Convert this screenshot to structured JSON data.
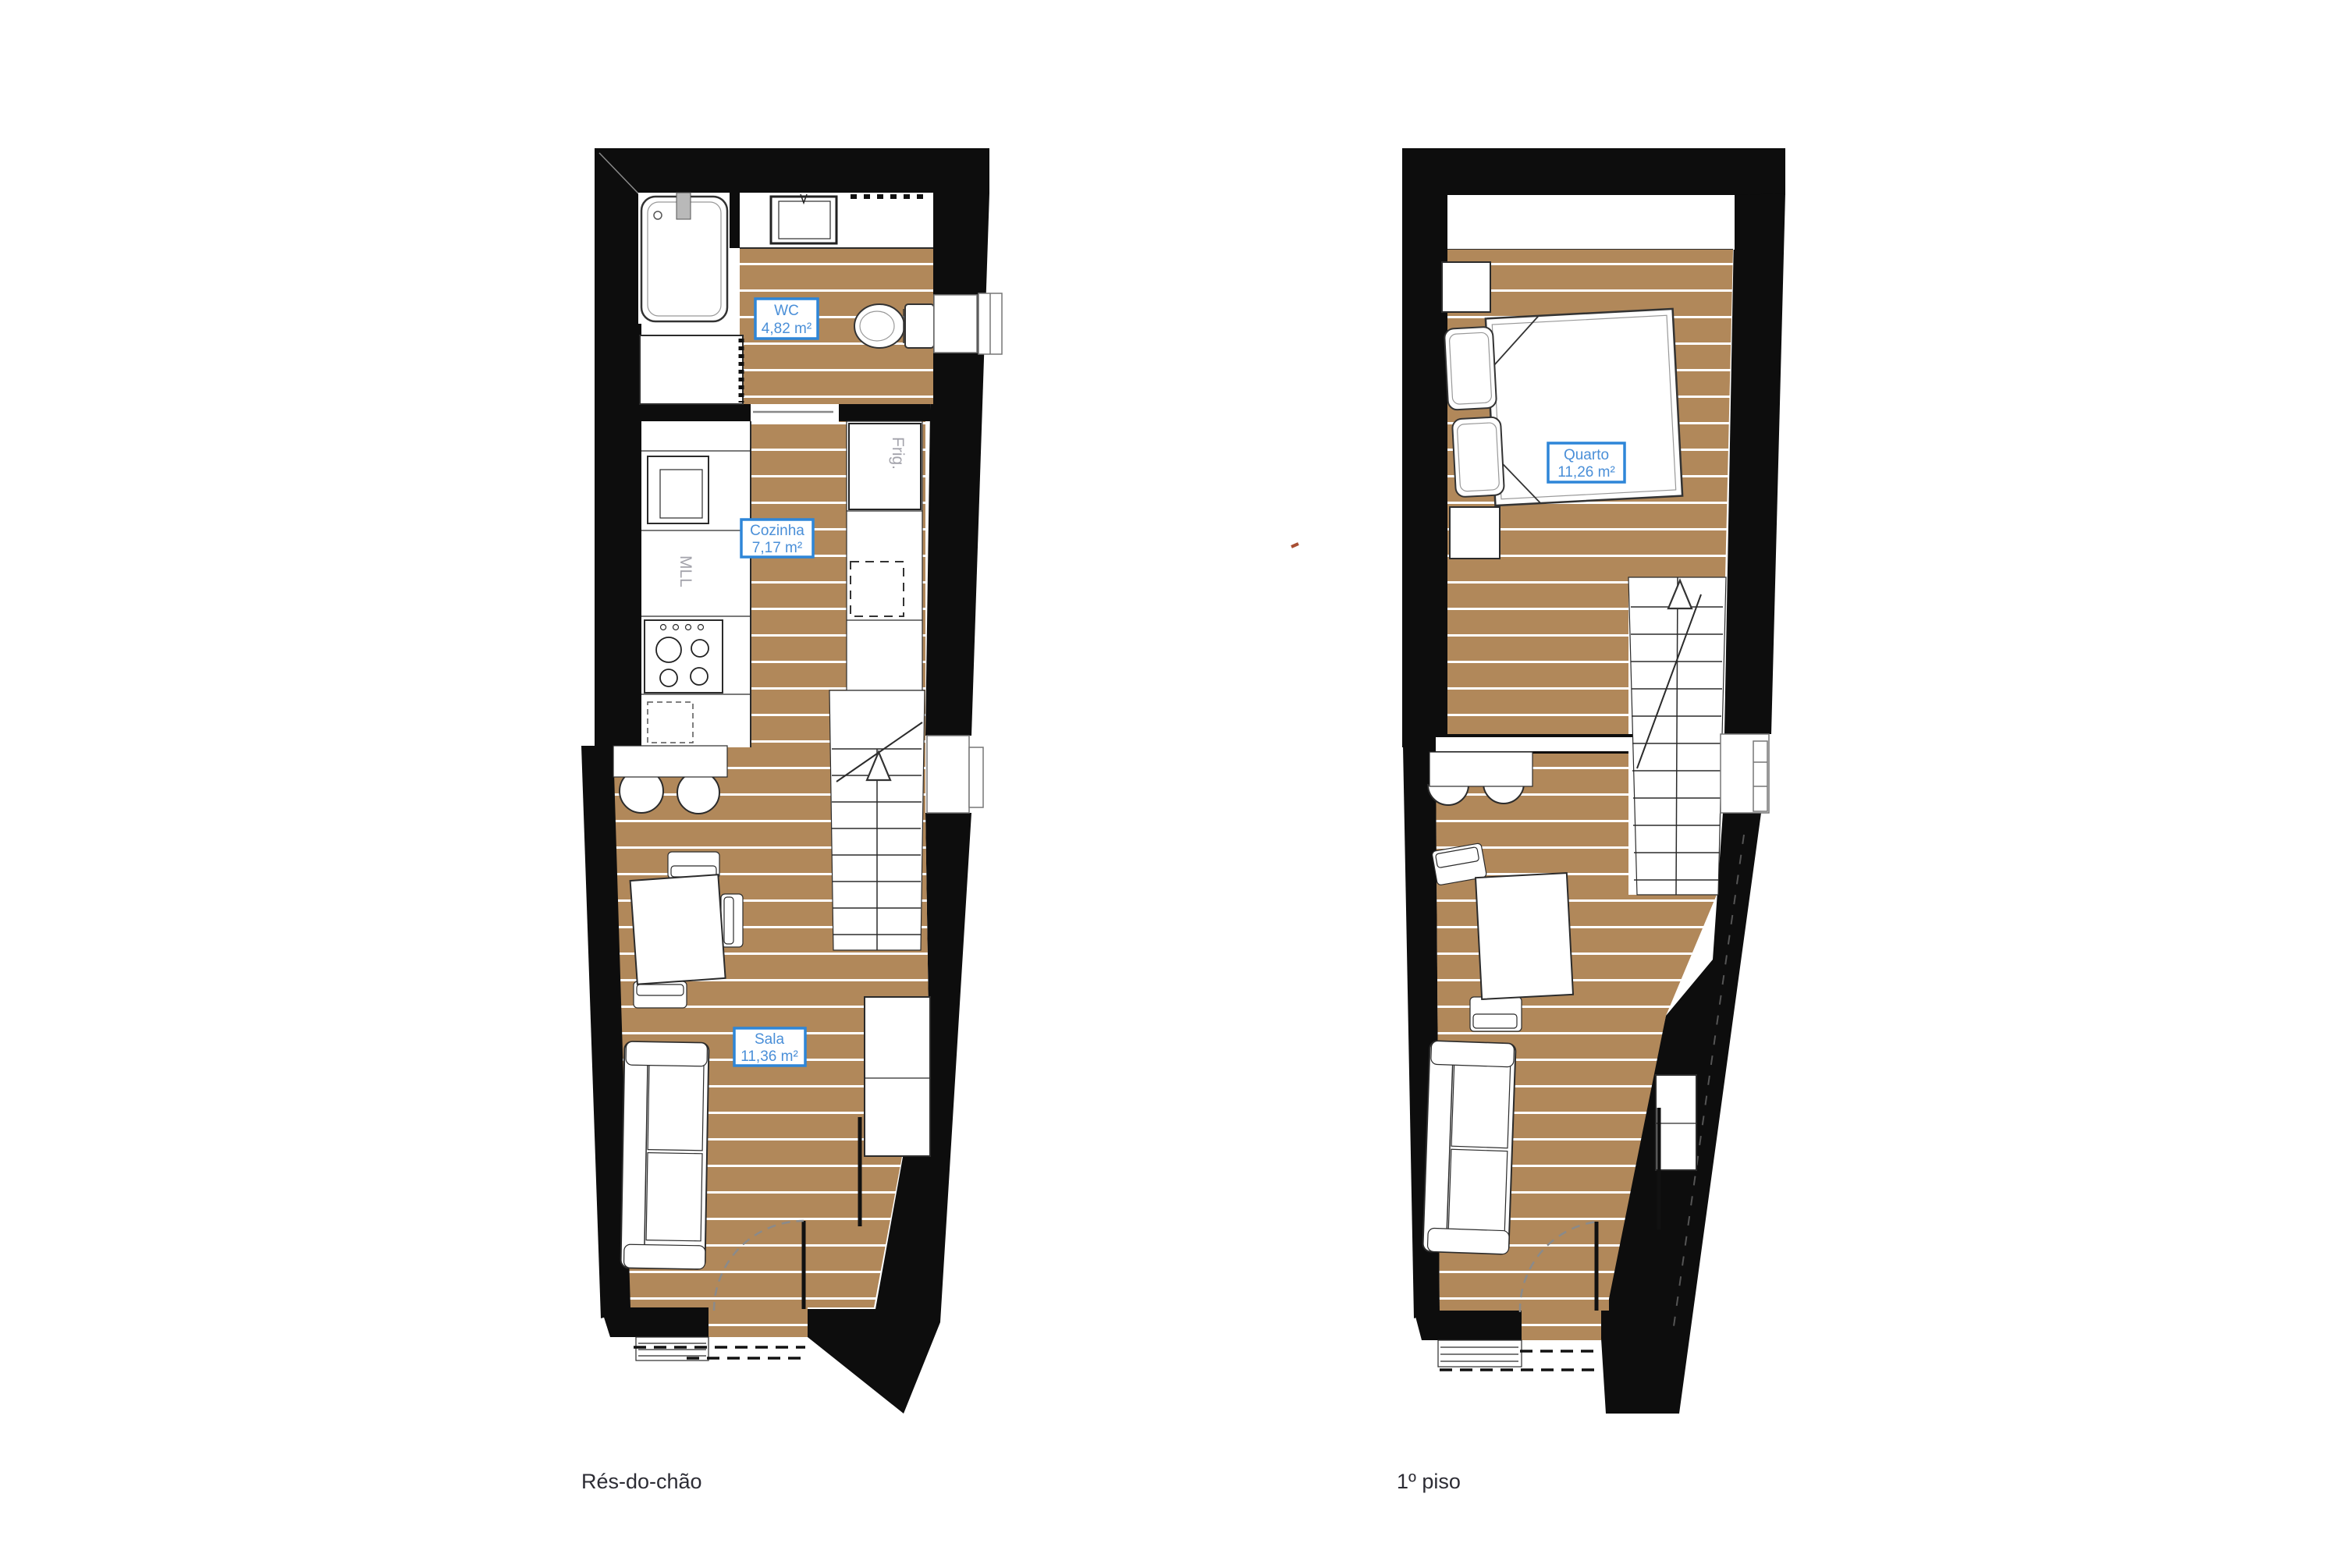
{
  "colors": {
    "wall": "#0d0d0d",
    "floor": "#b1885a",
    "plank_line": "#ffffff",
    "label_border": "#2e86d8",
    "label_text": "#4a8fd8",
    "appliance_text": "#a3a3ab",
    "caption_text": "#2c2c34",
    "accent_mark": "#a84f33"
  },
  "plans": [
    {
      "caption": "Rés-do-chão",
      "rooms": [
        {
          "name": "WC",
          "area": "4,82 m²"
        },
        {
          "name": "Cozinha",
          "area": "7,17 m²"
        },
        {
          "name": "Sala",
          "area": "11,36 m²"
        }
      ],
      "appliance_labels": {
        "fridge": "Frig.",
        "washing_machine": "MLL"
      }
    },
    {
      "caption": "1º piso",
      "rooms": [
        {
          "name": "Quarto",
          "area": "11,26 m²"
        }
      ]
    }
  ]
}
